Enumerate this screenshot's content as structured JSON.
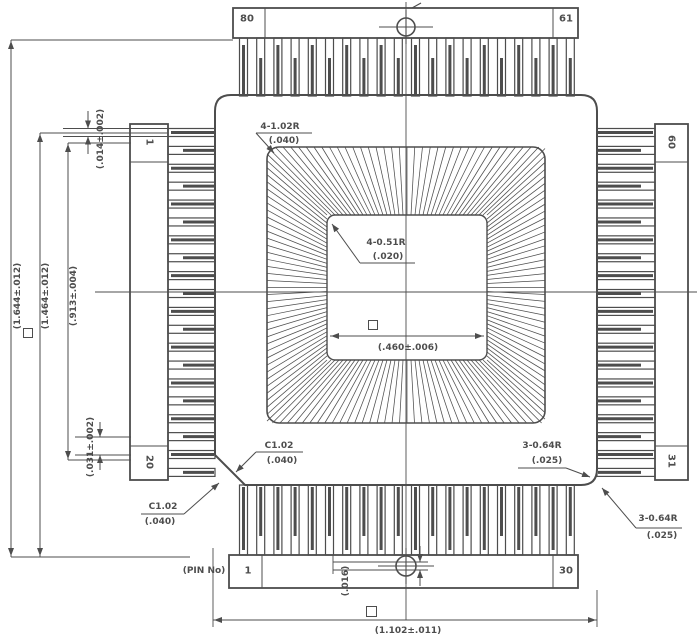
{
  "drawing": {
    "pins": {
      "top_left": "80",
      "top_right": "61",
      "right_top": "60",
      "right_bottom": "31",
      "bottom_left": "1",
      "bottom_right": "30",
      "left_top": "1",
      "left_bottom": "20",
      "pin_no_caption": "(PIN No)"
    },
    "dims": {
      "overall_v": "(1.644±.012)",
      "inner_v": "(1.464±.012)",
      "lead_span_v": "(.913±.004)",
      "lead_width": "(.014±.002)",
      "lead_pitch": "(.031±.002)",
      "cavity_radius_label": "4-1.02R",
      "cavity_radius_ref": "(.040)",
      "die_radius_label": "4-0.51R",
      "die_radius_ref": "(.020)",
      "die_width": "(.460±.006)",
      "chamfer_label": "C1.02",
      "chamfer_ref": "(.040)",
      "corner3_label": "3-0.64R",
      "corner3_ref": "(.025)",
      "lead_thickness": "(.016)",
      "overall_h": "(1.102±.011)"
    }
  }
}
